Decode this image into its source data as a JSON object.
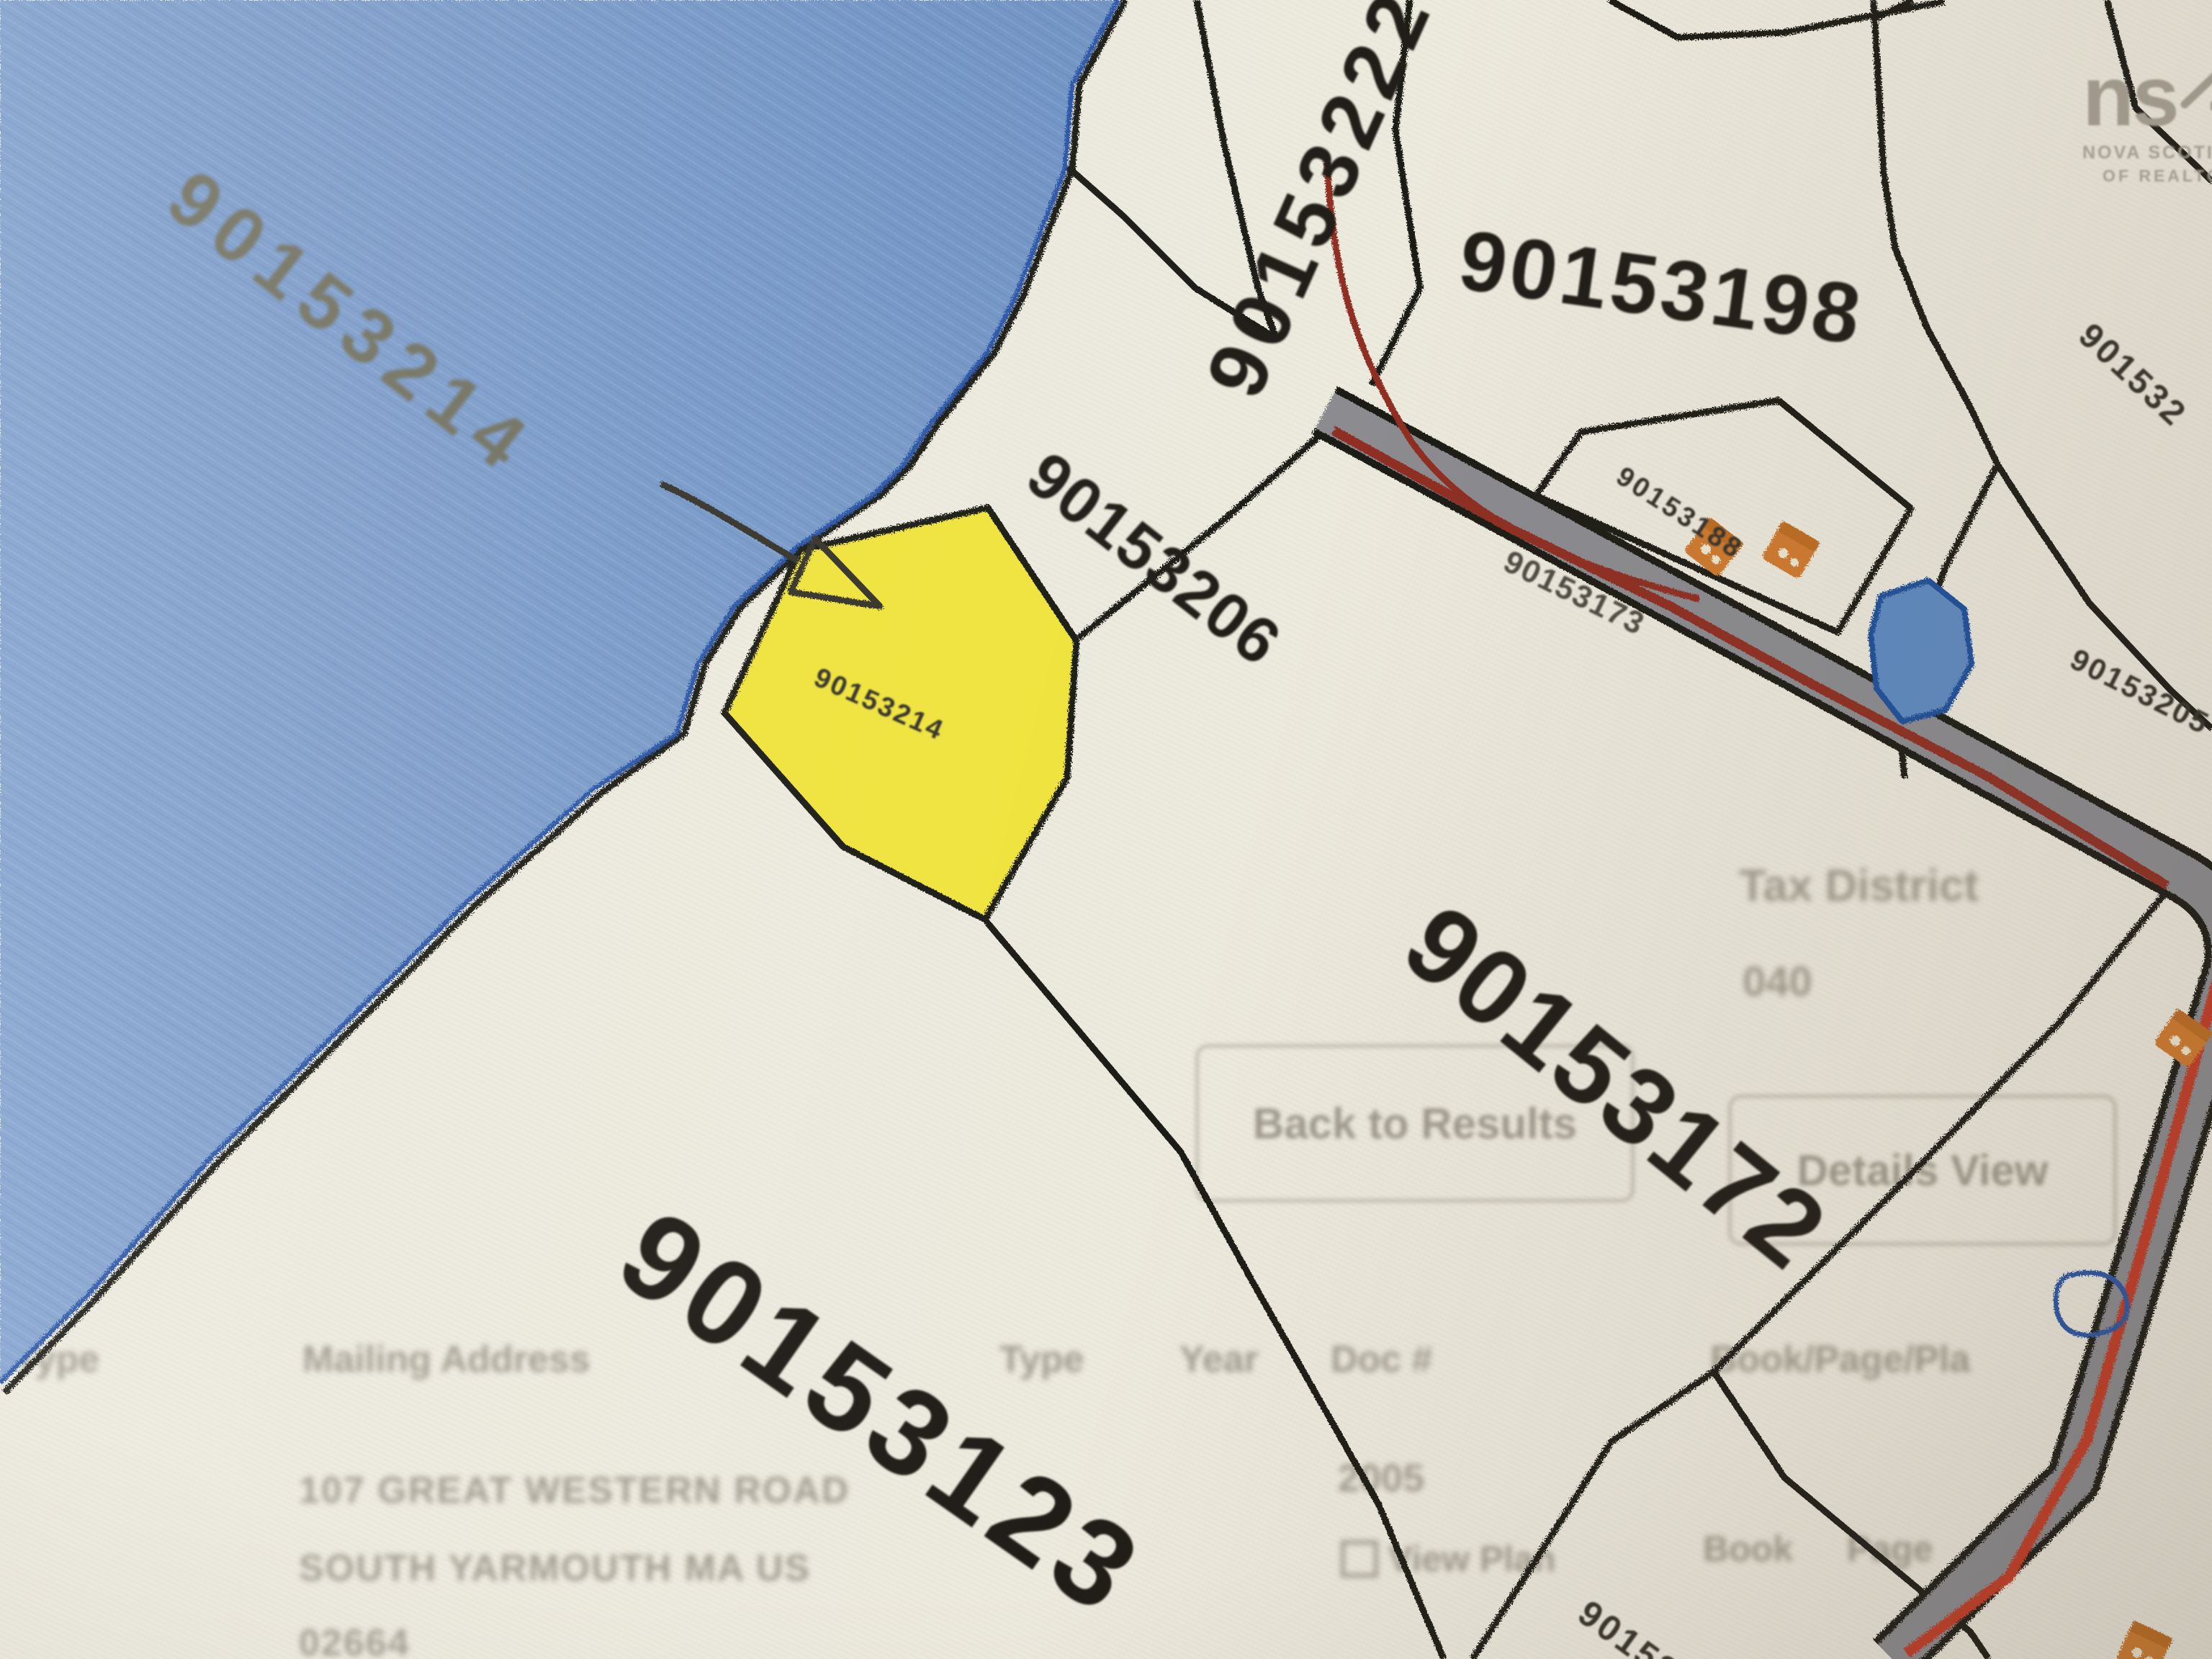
{
  "logo": {
    "text_ns": "ns",
    "text_ar": "ar",
    "tagline_line1": "NOVA SCOTIA ASSOCIATION",
    "tagline_line2": "OF REALTORS®"
  },
  "map": {
    "water_parcel_id": "90153214",
    "highlighted_parcel": {
      "id": "90153214"
    },
    "parcel_ids": {
      "strip": "90153222",
      "shore": "90153206",
      "north": "90153198",
      "small_lot": "90153188",
      "east_top": "901532",
      "east": "90153205",
      "road": "90153173",
      "central": "90153172",
      "southwest": "90153123",
      "south_small": "90153128"
    },
    "colors": {
      "water": "#7295c4",
      "water_edge": "#2a55a5",
      "highlight_yellow": "#efe33c",
      "road_fill": "#8b8b90",
      "road_stripe_dark": "#8f2f24",
      "road_stripe_bright": "#c23b28",
      "parcel_line": "#1c1a16",
      "building_orange": "#cf7a2e",
      "paper": "#ece9dd"
    }
  },
  "underlay": {
    "tax_district_label": "Tax District",
    "tax_district_value": "040",
    "back_button": "Back to Results",
    "details_button": "Details View",
    "table_headers": {
      "owner_type": "r Type",
      "mailing_address": "Mailing Address",
      "type": "Type",
      "year": "Year",
      "doc_number": "Doc #",
      "book_page": "Book/Page/Pla"
    },
    "mailing_address": {
      "line1": "107 GREAT WESTERN ROAD",
      "line2": "SOUTH YARMOUTH MA US",
      "line3": "02664"
    },
    "year_value": "2005",
    "view_plan_link": "View Plan",
    "book_label": "Book",
    "page_label": "Page"
  }
}
